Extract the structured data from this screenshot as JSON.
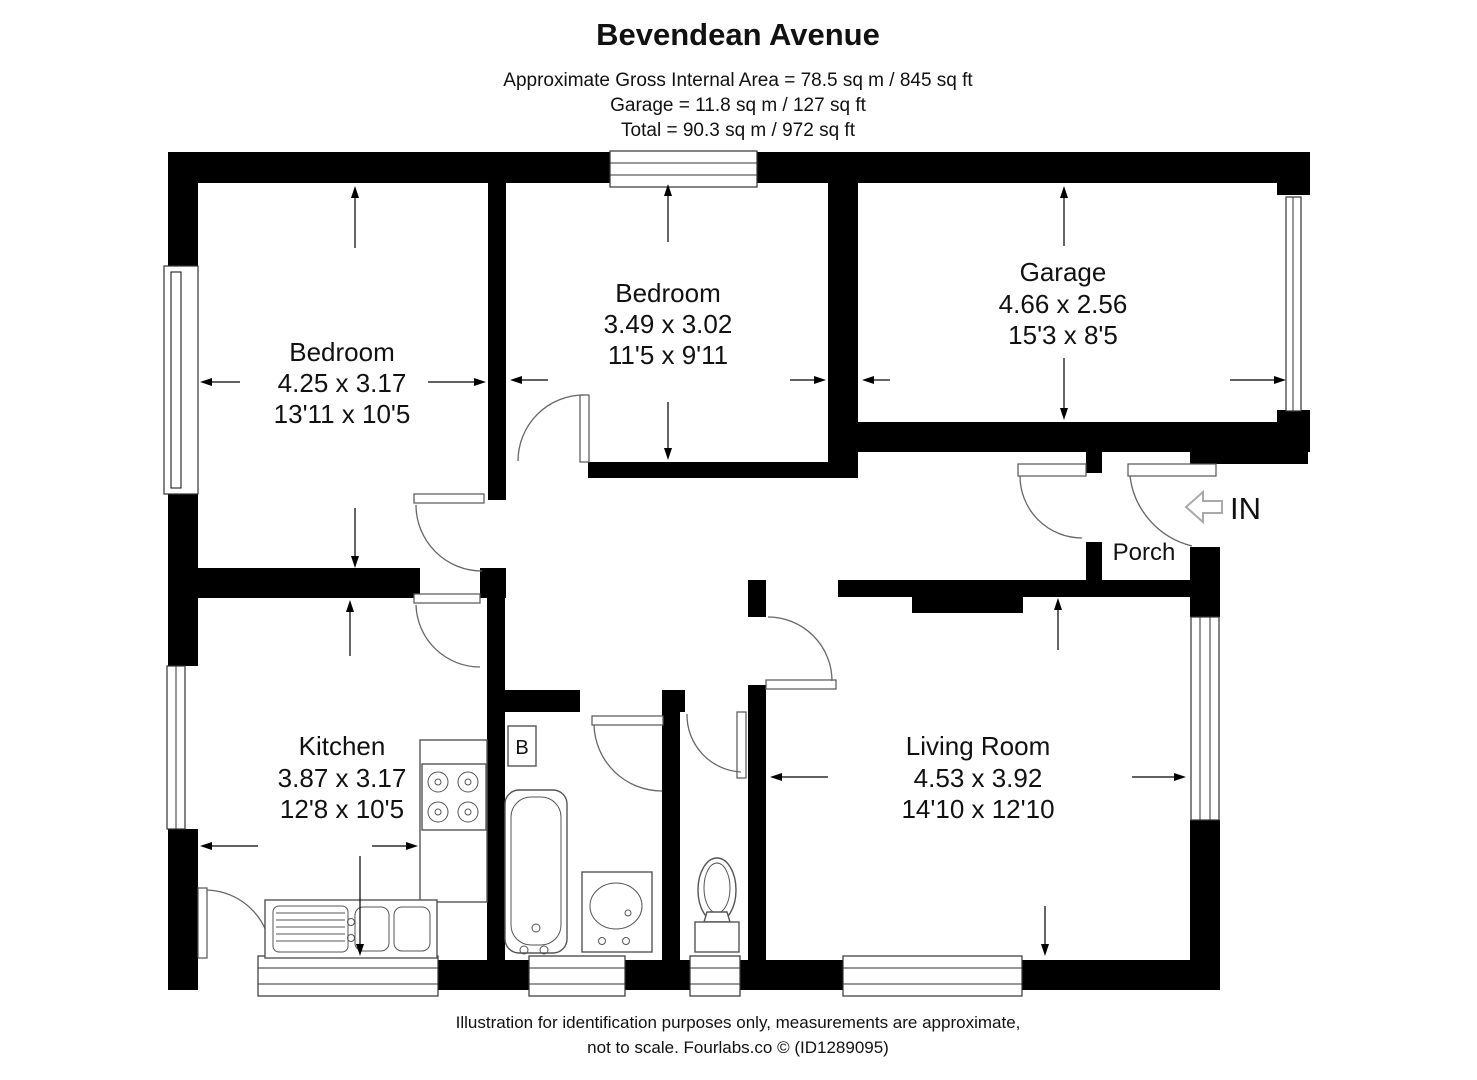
{
  "header": {
    "title": "Bevendean Avenue",
    "lines": [
      "Approximate Gross Internal Area = 78.5 sq m / 845 sq ft",
      "Garage = 11.8 sq m / 127 sq ft",
      "Total = 90.3 sq m / 972 sq ft"
    ]
  },
  "rooms": [
    {
      "name": "Bedroom",
      "metric": "4.25 x 3.17",
      "imperial": "13'11 x 10'5"
    },
    {
      "name": "Bedroom",
      "metric": "3.49 x 3.02",
      "imperial": "11'5 x 9'11"
    },
    {
      "name": "Garage",
      "metric": "4.66 x 2.56",
      "imperial": "15'3 x 8'5"
    },
    {
      "name": "Kitchen",
      "metric": "3.87 x 3.17",
      "imperial": "12'8 x 10'5"
    },
    {
      "name": "Living Room",
      "metric": "4.53 x 3.92",
      "imperial": "14'10 x 12'10"
    }
  ],
  "labels": {
    "porch": "Porch",
    "entrance_in": "IN",
    "boiler": "B"
  },
  "footer": {
    "lines": [
      "Illustration for identification purposes only, measurements are approximate,",
      "not to scale. Fourlabs.co © (ID1289095)"
    ]
  },
  "colors": {
    "wall": "#000000",
    "background": "#ffffff",
    "fixture_line": "#555555"
  }
}
